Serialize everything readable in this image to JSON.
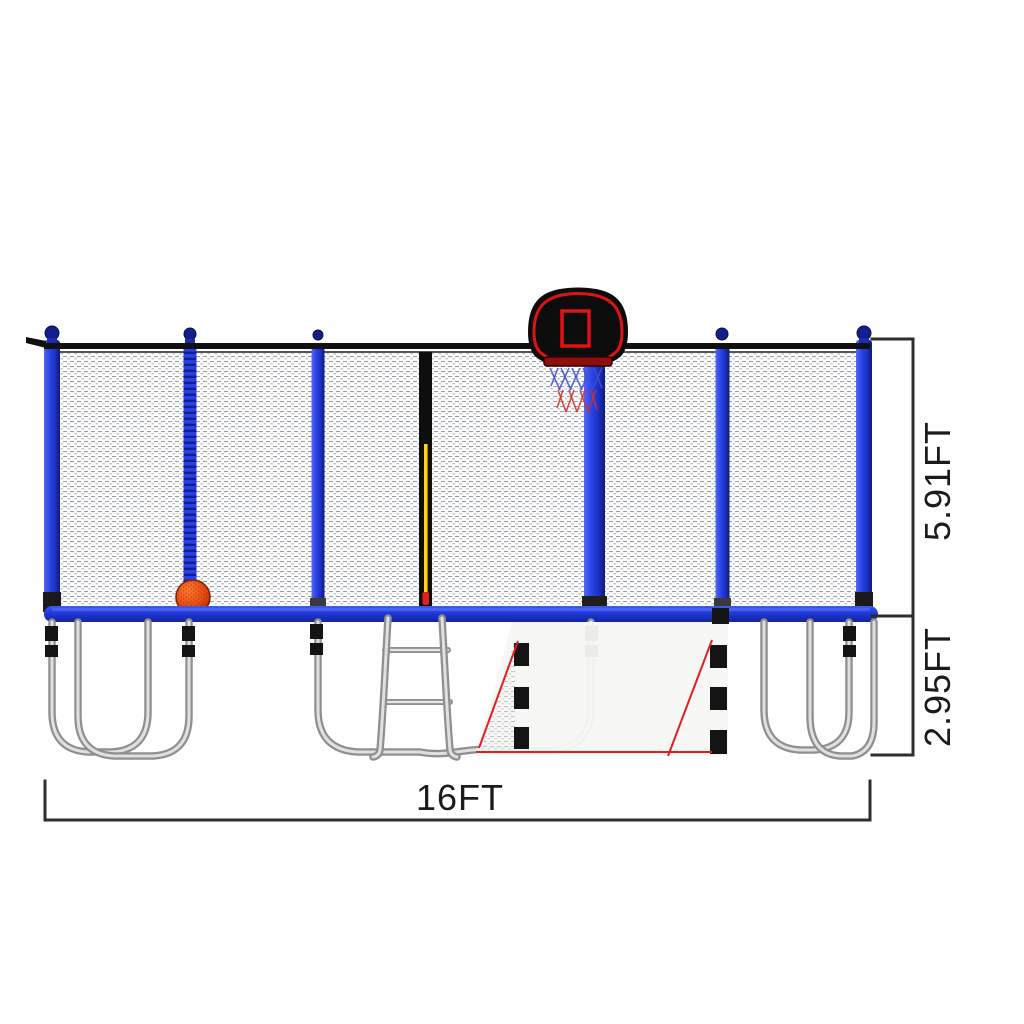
{
  "page": {
    "background": "#ffffff"
  },
  "diagram": {
    "type": "product-dimension-diagram",
    "subject": "16FT trampoline with blue safety enclosure poles, net, basketball hoop, ladder and galvanized legs",
    "labels": {
      "total_width": "16FT",
      "net_height": "5.91FT",
      "frame_height": "2.95FT"
    },
    "colors": {
      "pole_blue": "#2b44e8",
      "pad_blue": "#2038d8",
      "cap_navy": "#131f8e",
      "frame_metal": "#b9b9b9",
      "backboard_black": "#0c0c0c",
      "accent_red": "#e01212",
      "basketball_orange": "#e84a10",
      "zipper_yellow": "#ffd31c",
      "dimension_line": "#2e2e2e",
      "net_mesh_gray": "#9aa0a6",
      "skirt_white": "#f7f7f5"
    },
    "parts": [
      "enclosure-net",
      "safety-poles",
      "top-rail",
      "zipper-door",
      "basketball-backboard",
      "basketball-hoop-net",
      "basketball",
      "frame-pad",
      "trampoline-legs",
      "ladder",
      "lower-safety-skirt",
      "dimension-annotations"
    ]
  }
}
